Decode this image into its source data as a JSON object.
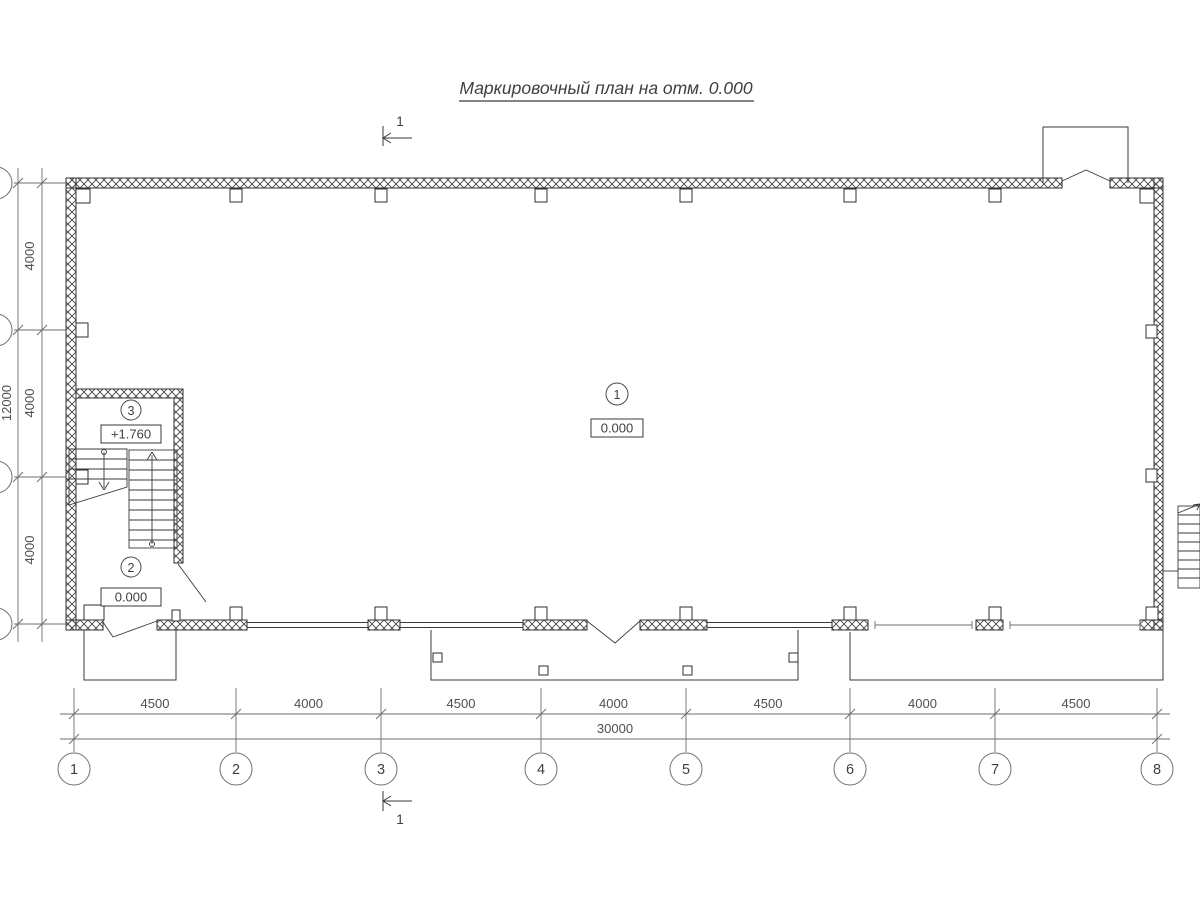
{
  "title": "Маркировочный план на отм. 0.000",
  "section_mark": {
    "label": "1"
  },
  "rooms": [
    {
      "number": "1",
      "level": "0.000"
    },
    {
      "number": "2",
      "level": "0.000"
    },
    {
      "number": "3",
      "level": "+1.760"
    }
  ],
  "grid_columns": {
    "labels": [
      "1",
      "2",
      "3",
      "4",
      "5",
      "6",
      "7",
      "8"
    ],
    "spacings": [
      "4500",
      "4000",
      "4500",
      "4000",
      "4500",
      "4000",
      "4500"
    ],
    "total": "30000"
  },
  "grid_rows": {
    "spacings": [
      "4000",
      "4000",
      "4000"
    ],
    "total": "12000"
  },
  "colors": {
    "background": "#ffffff",
    "wall_line": "#2f2f2f",
    "dimension_line": "#6e6e6e",
    "text": "#3f3f3f"
  }
}
